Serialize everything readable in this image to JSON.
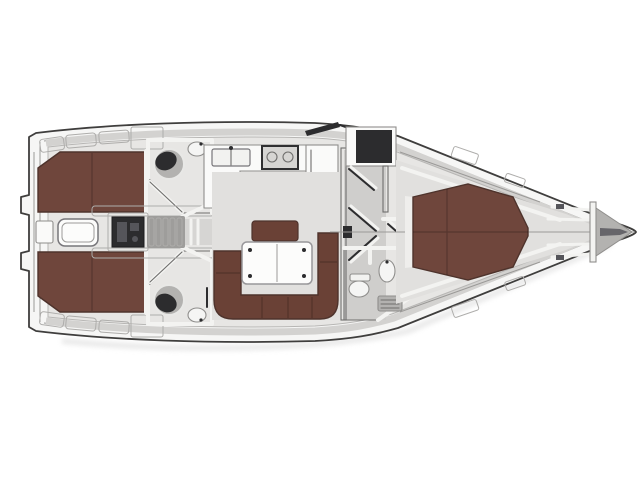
{
  "diagram": {
    "kind": "sailing-yacht-interior-floor-plan",
    "orientation": "bow-right-stern-left",
    "areas": [
      "swim-platform",
      "aft-cabin-port",
      "aft-cabin-starboard",
      "aft-head-port",
      "aft-head-starboard",
      "cockpit",
      "companionway-steps",
      "galley",
      "salon",
      "wardrobe-corridor",
      "forward-head",
      "owner-cabin",
      "foredeck",
      "anchor-locker"
    ],
    "fixtures": [
      "double-bed-port-aft",
      "double-bed-starboard-aft",
      "island-bed-forward",
      "toilet-port-aft",
      "toilet-starboard-aft",
      "toilet-forward",
      "sink-port-aft",
      "sink-starboard-aft",
      "sink-forward",
      "shower-port-aft",
      "shower-starboard-aft",
      "galley-sink",
      "stove",
      "fridge-cabinet",
      "cockpit-table",
      "salon-table",
      "chaise-bench",
      "u-settee",
      "engine-pedestal",
      "companionway-steps",
      "anchor"
    ]
  },
  "colors": {
    "bg": "#ffffff",
    "hull": "#f6f6f5",
    "outline": "#3f3e3d",
    "deck_strip": "#d3d2d0",
    "locker": "#f2f2f0",
    "white_box": "#fafaf9",
    "interior": "#e7e6e4",
    "salon_floor": "#e1e0de",
    "corridor_floor": "#cfcecc",
    "room_floor": "#c9c8c6",
    "head_floor": "#d6d5d3",
    "bed": "#6f463c",
    "bed_edge": "#4e332c",
    "settee": "#6a4136",
    "table": "#fcfcfb",
    "white_wall": "#f3f3f1",
    "fixture_dark": "#2c2c2e",
    "fixture_mid": "#55555a",
    "gray_pan": "#b3b2b0",
    "porcelain": "#f5f5f4",
    "metal": "#8f8e8c",
    "steps_bg": "#9e9d9b",
    "anchor_bay": "#b3b2b0",
    "anchor": "#66656a",
    "shadow": "#d9d9d9",
    "seam_dark": "rgba(0,0,0,0.22)",
    "headboard": "#efeeec"
  }
}
